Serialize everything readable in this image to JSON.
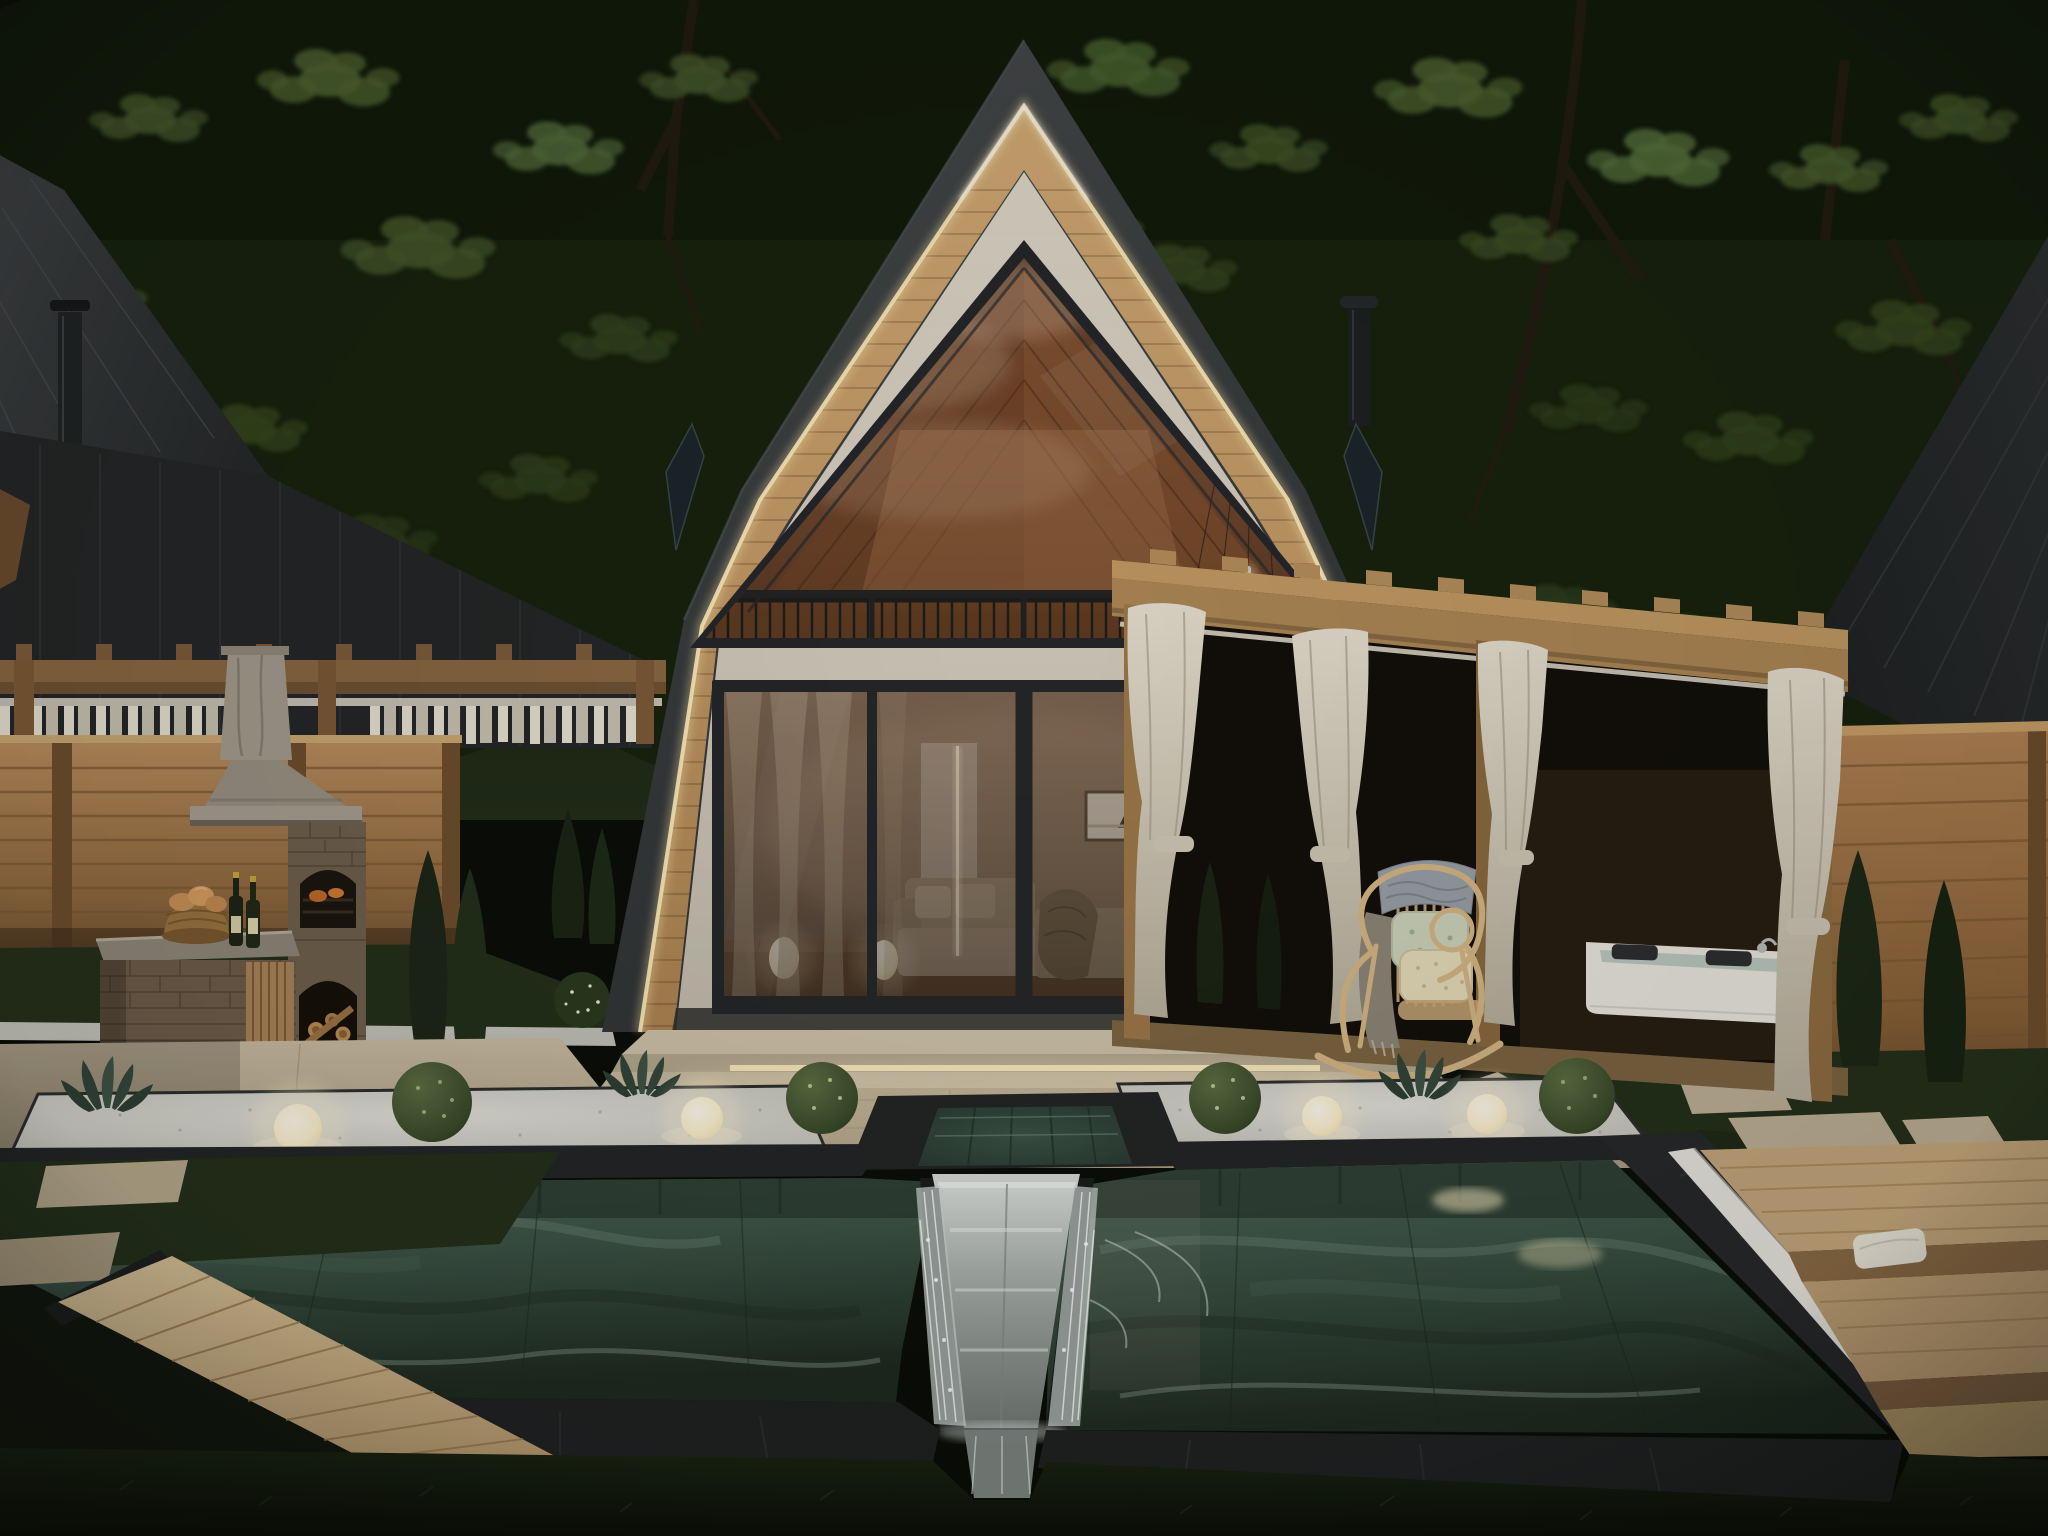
{
  "scene": {
    "title": "Modern A-frame house backyard at dusk",
    "description": "Photorealistic dusk rendering of a barn-style A-frame house with a warm LED-lit roofline and triangular glass gable, sliding glass doors revealing a lit living room, stone terrace with under-step lighting, landscaped gravel planters with glowing sphere lamps, a dark-tiled swimming pool with a central stainless waterfall chute, a brick barbecue by a wooden fence, a curtained wooden cabana with a white jacuzzi, a rattan rocking chair, dark neighboring gabled roofs and dense trees behind"
  },
  "palette": {
    "canopy": "#1e2817",
    "leafHighlight": "#4c6231",
    "roofDark": "#3a3d3f",
    "neighborRoof": "#26282a",
    "ledWarm": "#ffedc0",
    "wood": "#c49a66",
    "cream": "#d5cec1",
    "glassWarm": "#8a5f41",
    "frameDark": "#24262a",
    "stone": "#c4b69d",
    "gravel": "#d7d6d0",
    "lawn": "#24301b",
    "lawnDark": "#11160d",
    "fence": "#a87c4f",
    "brick": "#6e5b48",
    "marbleStone": "#9c968b",
    "poolTeal": "#3e574c",
    "steel": "#b9bfbc",
    "curtain": "#ddd5c6",
    "rattan": "#d6b786",
    "tub": "#ebe8e0",
    "lampGlow": "#fff6dc",
    "bush": "#43552f"
  },
  "objects": {
    "house": "a-frame house",
    "pool": "swimming pool with waterfall chute",
    "bbq": "brick barbecue grill",
    "cabana": "pergola cabana with jacuzzi",
    "chair": "rattan rocking chair",
    "lamps": "glowing sphere garden lamps",
    "trees": "dense tree canopy"
  }
}
